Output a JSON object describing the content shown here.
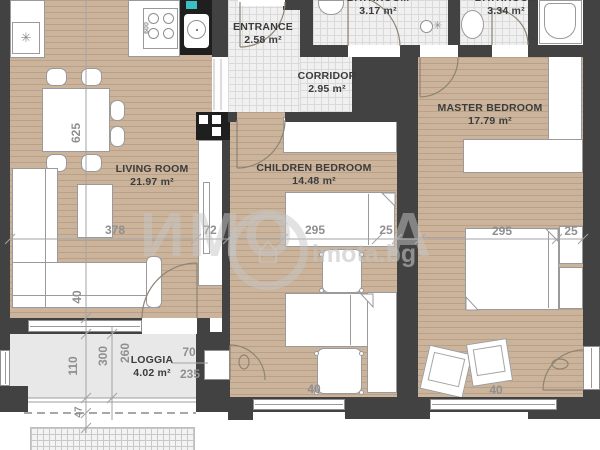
{
  "plan": {
    "rooms": {
      "living_room": {
        "name": "LIVING ROOM",
        "area": "21.97 m²"
      },
      "entrance": {
        "name": "ENTRANCE",
        "area": "2.58 m²"
      },
      "corridor": {
        "name": "CORRIDOR",
        "area": "2.95 m²"
      },
      "bathroom_1": {
        "name": "BATHROOM",
        "area": "3.17 m²"
      },
      "bathroom_2": {
        "name": "BATHROOM",
        "area": "3.34 m²"
      },
      "children_bedroom": {
        "name": "CHILDREN BEDROOM",
        "area": "14.48 m²"
      },
      "master_bedroom": {
        "name": "MASTER BEDROOM",
        "area": "17.79 m²"
      },
      "loggia": {
        "name": "LOGGIA",
        "area": "4.02 m²"
      }
    },
    "dimensions": {
      "living_height": "625",
      "sofa_span": "378",
      "tv_niche": "72",
      "living_wall": "40",
      "children_bed_length": "295",
      "children_bed_head": "25",
      "children_door_width": "40",
      "master_bed_length": "295",
      "master_bed_head": "25",
      "master_door_width": "40",
      "loggia_depth": "110",
      "loggia_300": "300",
      "loggia_260": "260",
      "loggia_70": "70",
      "loggia_235": "235",
      "overhang": "47",
      "stove_width": "600"
    },
    "watermark": {
      "brand_left": "ИМО",
      "brand_right": "А",
      "house_glyph": "⌂",
      "site": "imota.bg"
    },
    "icons": {
      "freezer": "✳"
    },
    "colors": {
      "wall": "#424242",
      "wood_floor": "#cbb49b",
      "tile_floor": "#f0f0f0",
      "loggia_floor": "#e8e8e8",
      "teal_accent": "#3bbfc4",
      "dimension_text": "#8f8f8f",
      "label_text": "#3c3c3c",
      "watermark": "#c6c6c6"
    }
  }
}
